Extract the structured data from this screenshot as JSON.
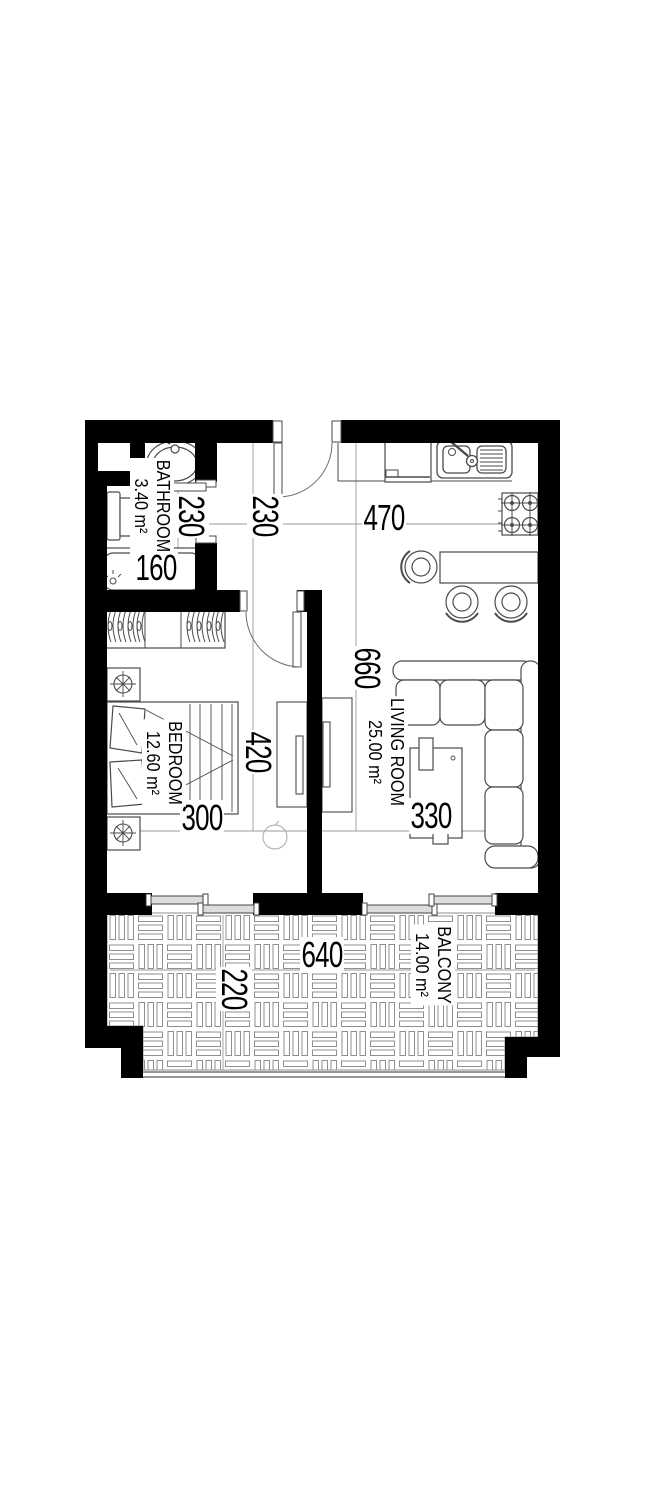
{
  "drawing": {
    "type": "apartment-floor-plan",
    "background": "#ffffff",
    "wall_color": "#000000",
    "furniture_line_color": "#4a4a4a",
    "dim_line_color": "#9a9a9a",
    "tile_pattern_color": "#8f8f8f"
  },
  "rooms": [
    {
      "name": "BATHROOM",
      "area": "3.40 m²"
    },
    {
      "name": "BEDROOM",
      "area": "12.60 m²"
    },
    {
      "name": "LIVING ROOM",
      "area": "25.00 m²"
    },
    {
      "name": "BALCONY",
      "area": "14.00 m²"
    }
  ],
  "dimensions": {
    "bathroom_width": "230",
    "hall_width": "230",
    "kitchen_width": "470",
    "living_length": "660",
    "bedroom_length": "420",
    "bed_width": "300",
    "coffee_table_length": "330",
    "bathtub_length": "160",
    "balcony_width": "640",
    "balcony_depth": "220"
  },
  "fixtures": [
    "entry-door",
    "bathroom-door",
    "bedroom-door",
    "duct-niche",
    "wash-basin",
    "toilet",
    "bathtub",
    "wardrobe",
    "double-bed",
    "pillow",
    "nightstand",
    "table-lamp",
    "tv-unit",
    "floor-lamp",
    "fridge",
    "kitchen-counter",
    "kitchen-sink",
    "stove",
    "bar-counter",
    "bar-stool",
    "corner-sofa",
    "coffee-table",
    "sliding-window",
    "balcony-tile-floor",
    "railing"
  ]
}
